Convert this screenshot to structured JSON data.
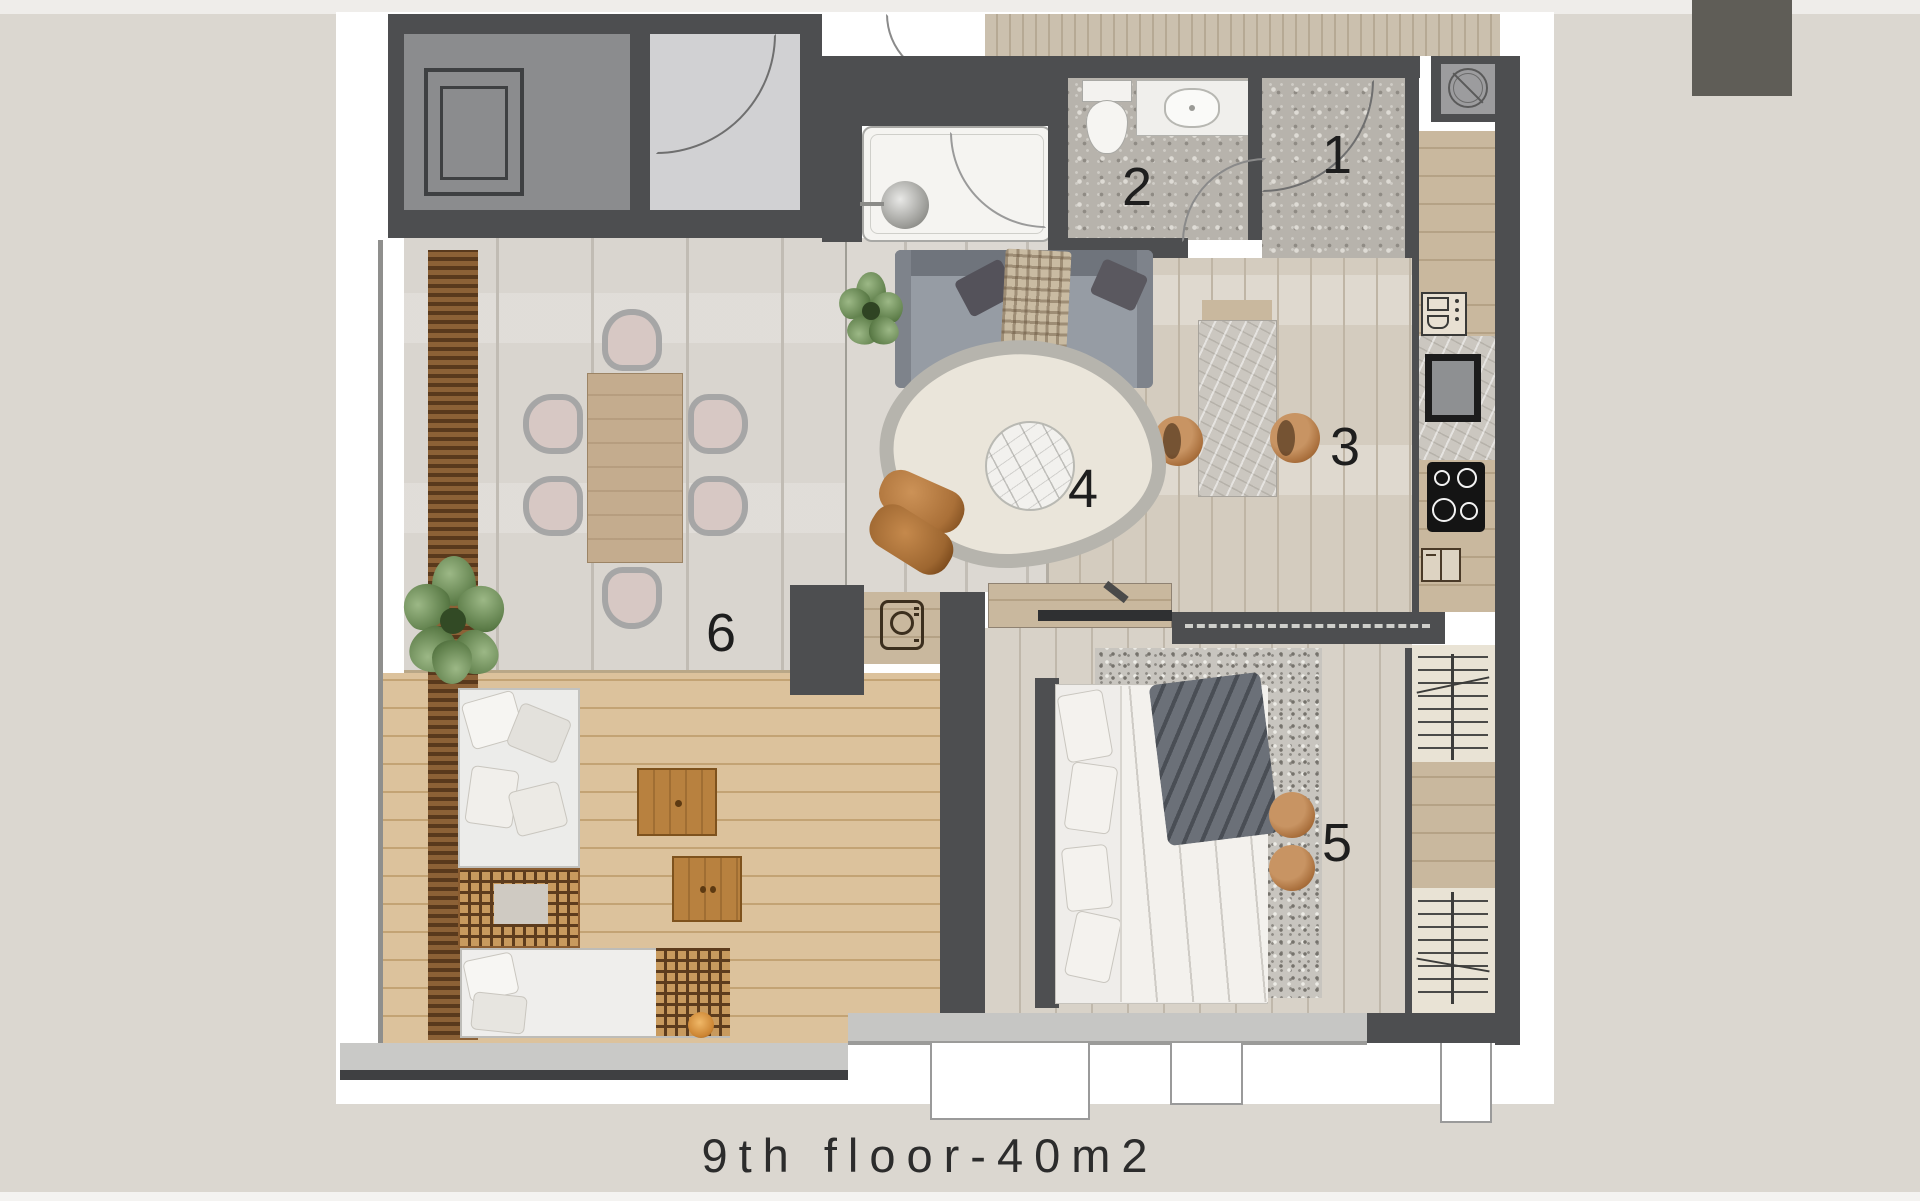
{
  "title_caption": "9th floor-40m2",
  "rooms": [
    {
      "id": 1,
      "label": "1"
    },
    {
      "id": 2,
      "label": "2"
    },
    {
      "id": 3,
      "label": "3"
    },
    {
      "id": 4,
      "label": "4"
    },
    {
      "id": 5,
      "label": "5"
    },
    {
      "id": 6,
      "label": "6"
    }
  ],
  "icons": {
    "elevator": "nested-squares",
    "vent_shaft": "circle-with-slash",
    "washing_machine": "square-with-drum-circle",
    "oven_microwave": "stacked-appliance-rects",
    "sink_unit": "black-framed-square",
    "cooktop": "black-square-4-burners",
    "dishwasher": "small-split-rect",
    "wardrobe_rail": "rail-with-hangers"
  },
  "colors": {
    "background": "#dbd7d0",
    "sheet": "#ffffff",
    "wall": "#4d4e50",
    "deck_wood": "#dcc29c",
    "accent_wood": "#b07a45",
    "corner_tab": "#5f5d57"
  }
}
